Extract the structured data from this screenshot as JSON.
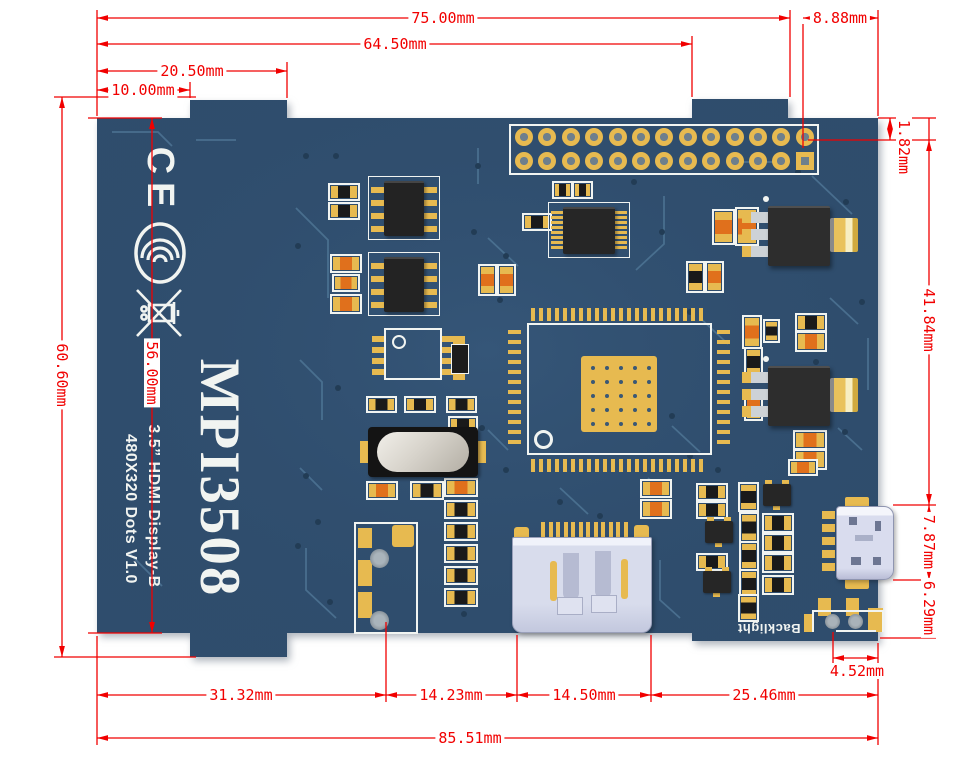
{
  "board": {
    "model": "MPI3508",
    "subtitle_line1": "3.5” HDMI Display-B",
    "subtitle_line2": "480X320 Dots V1.0",
    "backlight_label": "Backlight",
    "marks": {
      "ce": "CE",
      "ccc": "ccc-certification-mark",
      "weee": "weee-crossed-out-bin-mark"
    }
  },
  "dimensions": {
    "unit": "mm",
    "top": [
      {
        "label": "75.00mm",
        "value": 75.0
      },
      {
        "label": "64.50mm",
        "value": 64.5
      },
      {
        "label": "20.50mm",
        "value": 20.5
      },
      {
        "label": "10.00mm",
        "value": 10.0
      },
      {
        "label": "8.88mm",
        "value": 8.88
      }
    ],
    "left": [
      {
        "label": "60.60mm",
        "value": 60.6
      },
      {
        "label": "56.00mm",
        "value": 56.0
      }
    ],
    "right": [
      {
        "label": "1.82mm",
        "value": 1.82
      },
      {
        "label": "41.84mm",
        "value": 41.84
      },
      {
        "label": "7.87mm",
        "value": 7.87
      },
      {
        "label": "6.29mm",
        "value": 6.29
      }
    ],
    "bottom": [
      {
        "label": "31.32mm",
        "value": 31.32
      },
      {
        "label": "14.23mm",
        "value": 14.23
      },
      {
        "label": "14.50mm",
        "value": 14.5
      },
      {
        "label": "25.46mm",
        "value": 25.46
      },
      {
        "label": "4.52mm",
        "value": 4.52
      },
      {
        "label": "85.51mm",
        "value": 85.51
      }
    ]
  },
  "colors": {
    "dimension_red": "#f10000",
    "pcb_navy": "#2f4d6d",
    "pad_gold": "#e7ba50",
    "silkscreen_white": "#f1f4f1",
    "chip_black": "#1a1a1a",
    "resistor_orange": "#e0701c",
    "connector_silver": "#d9dcee",
    "trace_blue": "#4d7494"
  }
}
